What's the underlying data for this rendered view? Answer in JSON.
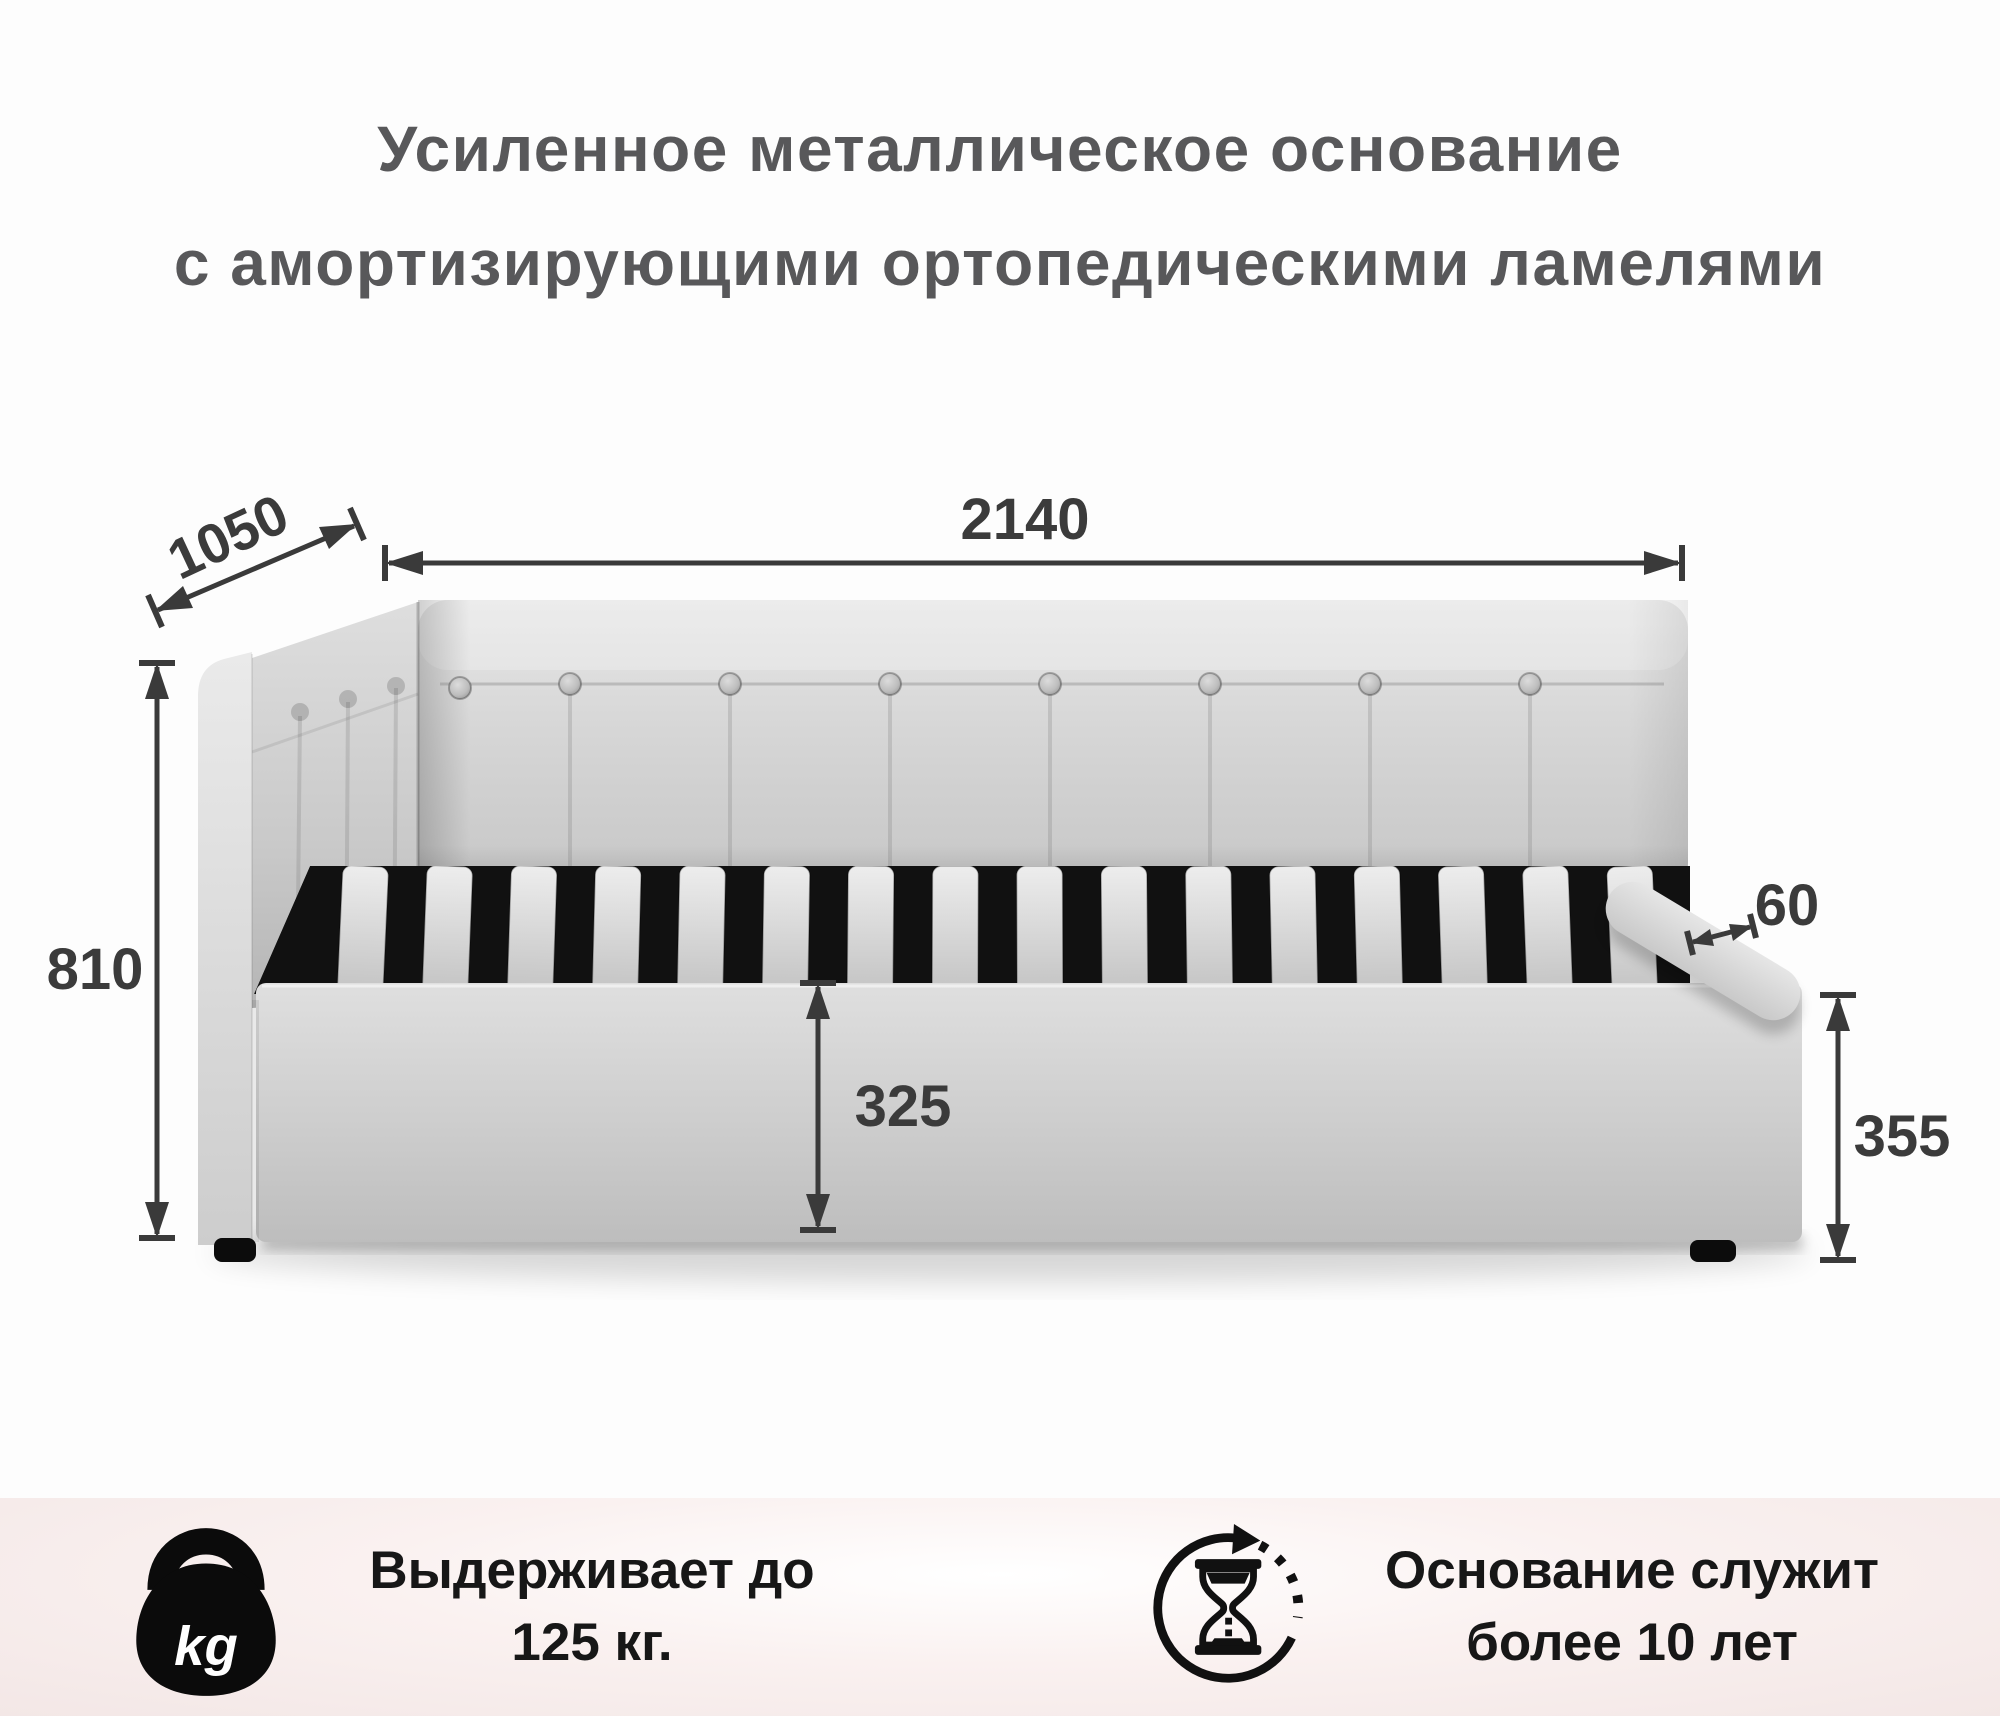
{
  "title": {
    "line1": "Усиленное металлическое основание",
    "line2": "с амортизирующими ортопедическими ламелями"
  },
  "dimensions": {
    "depth_mm": "1050",
    "width_mm": "2140",
    "height_mm": "810",
    "base_height_mm": "325",
    "slat_width_mm": "60",
    "side_height_mm": "355"
  },
  "features": {
    "weight_capacity": {
      "icon": "kettlebell-kg-icon",
      "icon_text": "kg",
      "line1": "Выдерживает до",
      "line2": "125 кг."
    },
    "durability": {
      "icon": "hourglass-cycle-icon",
      "line1": "Основание служит",
      "line2": "более 10 лет"
    }
  },
  "colors": {
    "title_text": "#58585a",
    "dimension_text": "#3b3b3b",
    "band_background": "#f4e9e8",
    "feature_text": "#171717",
    "fabric": "#d3d3d3",
    "slat_frame": "#111111"
  }
}
